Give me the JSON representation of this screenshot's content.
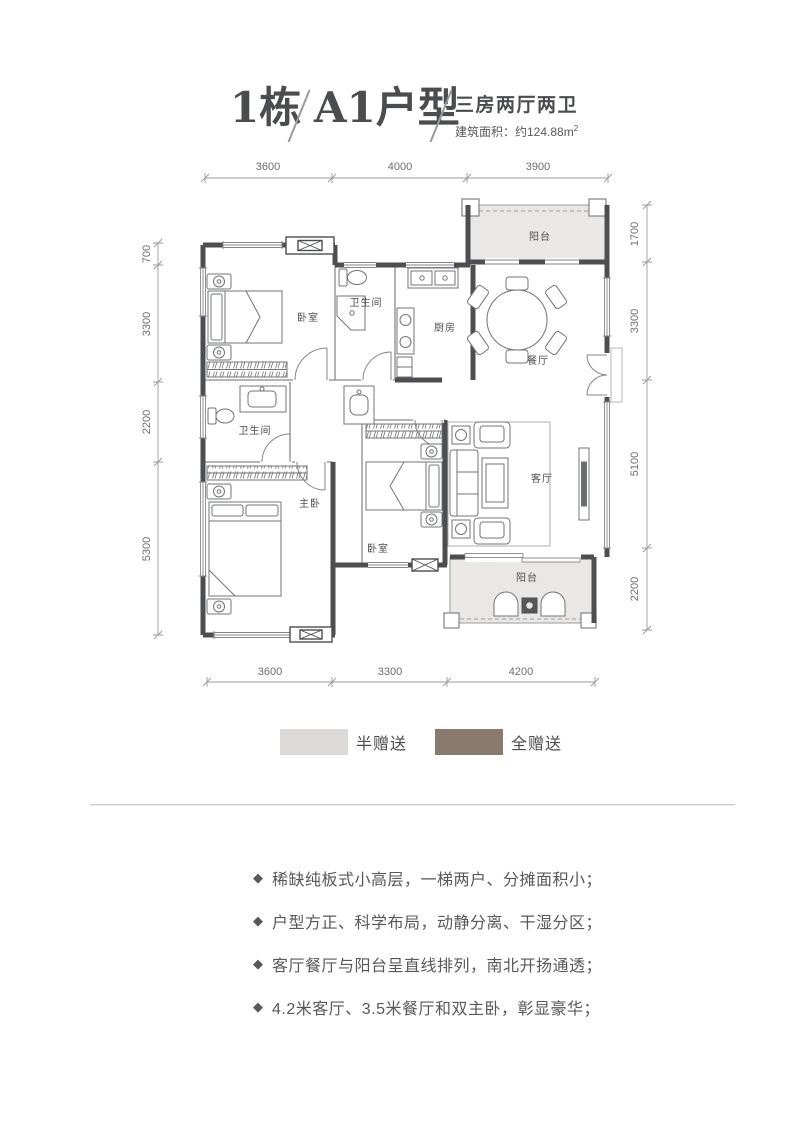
{
  "title": {
    "building": "1栋",
    "unit": "A1户型",
    "layout": "三房两厅两卫",
    "area": "建筑面积：约124.88m",
    "area_sup": "2"
  },
  "plan": {
    "dims_top": [
      "3600",
      "4000",
      "3900"
    ],
    "dims_bottom": [
      "3600",
      "3300",
      "4200"
    ],
    "dims_left": [
      "700",
      "3300",
      "2200",
      "5300"
    ],
    "dims_right": [
      "1700",
      "3300",
      "5100",
      "2200"
    ],
    "rooms": {
      "balcony_top": "阳台",
      "bedroom_top": "卧室",
      "bath_top": "卫生间",
      "kitchen": "厨房",
      "dining": "餐厅",
      "bath_left": "卫生间",
      "master": "主卧",
      "bedroom_bottom": "卧室",
      "living": "客厅",
      "balcony_bottom": "阳台"
    },
    "colors": {
      "wall": "#4d4e50",
      "half_gift_fill": "#e9e8e6",
      "full_gift_marker": "#56575a"
    }
  },
  "legend": [
    {
      "label": "半赠送",
      "color": "#dcdad8"
    },
    {
      "label": "全赠送",
      "color": "#8a7a6e"
    }
  ],
  "features": [
    "稀缺纯板式小高层，一梯两户、分摊面积小；",
    "户型方正、科学布局，动静分离、干湿分区；",
    "客厅餐厅与阳台呈直线排列，南北开扬通透；",
    "4.2米客厅、3.5米餐厅和双主卧，彰显豪华；"
  ]
}
